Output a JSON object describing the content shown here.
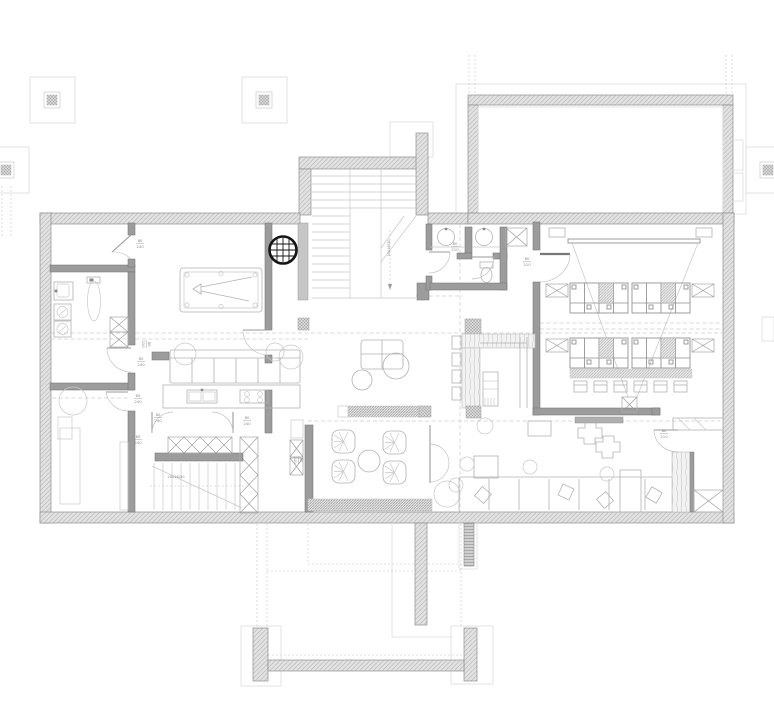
{
  "drawing": {
    "kind": "architectural-floor-plan",
    "level": "basement-entertainment-floor"
  },
  "colors": {
    "background": "#ffffff",
    "wall_fill": "#e2e2e2",
    "wall_hatch": "#aeaeae",
    "wall_edge": "#8f8f8f",
    "interior_wall": "#9c9c9c",
    "furniture_line": "#b2b2b2",
    "dashed_line": "#cbcbcb",
    "dartboard": "#151515",
    "annotation_text": "#8a8a8a"
  },
  "annotations": {
    "door_labels": [
      {
        "x": 140,
        "y": 243,
        "top": "80",
        "bottom": "240",
        "rot": 0
      },
      {
        "x": 141,
        "y": 361,
        "top": "80",
        "bottom": "240",
        "rot": 0
      },
      {
        "x": 147,
        "y": 344,
        "top": "80",
        "bottom": "210",
        "rot": 90
      },
      {
        "x": 138,
        "y": 398,
        "top": "80",
        "bottom": "240",
        "rot": 0
      },
      {
        "x": 158,
        "y": 417,
        "top": "80",
        "bottom": "240",
        "rot": 0
      },
      {
        "x": 247,
        "y": 420,
        "top": "80",
        "bottom": "240",
        "rot": 0
      },
      {
        "x": 138,
        "y": 439,
        "top": "80",
        "bottom": "240",
        "rot": 0
      },
      {
        "x": 299,
        "y": 460,
        "top": "80",
        "bottom": "240",
        "rot": 90
      },
      {
        "x": 455,
        "y": 246,
        "top": "80",
        "bottom": "210",
        "rot": 0
      },
      {
        "x": 527,
        "y": 261,
        "top": "80",
        "bottom": "210",
        "rot": 0
      },
      {
        "x": 664,
        "y": 433,
        "top": "80",
        "bottom": "210",
        "rot": 0
      }
    ],
    "stair_labels": [
      {
        "x": 390,
        "y": 248,
        "text": "20x16/30",
        "rot": -90
      },
      {
        "x": 176,
        "y": 478,
        "text": "20x16/30",
        "rot": 0
      }
    ]
  }
}
